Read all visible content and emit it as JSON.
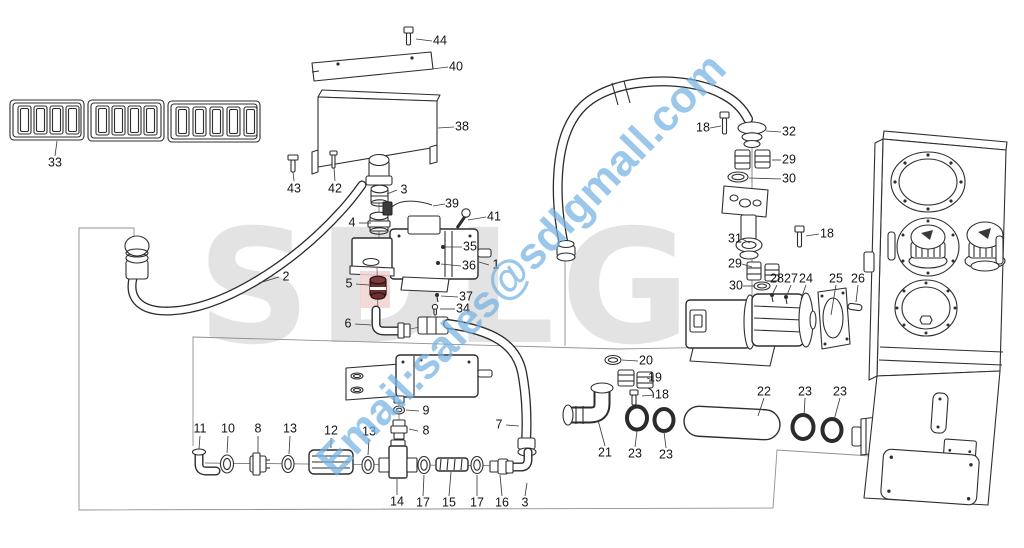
{
  "watermarks": {
    "brand": "SDLG",
    "brand_color": "#000000",
    "brand_opacity": 0.105,
    "email": "Email:sales@sdlgmall.com",
    "email_color": "#74b2e2",
    "email_opacity": 0.72
  },
  "highlight": {
    "part": "5",
    "color": "#f2d2d2"
  },
  "callouts": [
    {
      "n": "44",
      "x": 440,
      "y": 41,
      "leader": [
        432,
        41,
        416,
        39
      ]
    },
    {
      "n": "40",
      "x": 456,
      "y": 67,
      "leader": [
        448,
        67,
        432,
        69
      ]
    },
    {
      "n": "38",
      "x": 462,
      "y": 127,
      "leader": [
        454,
        127,
        438,
        128
      ]
    },
    {
      "n": "33",
      "x": 55,
      "y": 163,
      "leader": [
        55,
        156,
        57,
        141
      ]
    },
    {
      "n": "43",
      "x": 294,
      "y": 189,
      "leader": [
        294,
        181,
        293,
        172
      ]
    },
    {
      "n": "42",
      "x": 335,
      "y": 189,
      "leader": [
        335,
        181,
        334,
        168
      ]
    },
    {
      "n": "3",
      "x": 404,
      "y": 190,
      "leader": [
        397,
        190,
        387,
        194
      ]
    },
    {
      "n": "39",
      "x": 452,
      "y": 204,
      "leader": [
        445,
        204,
        433,
        206
      ]
    },
    {
      "n": "41",
      "x": 494,
      "y": 217,
      "leader": [
        486,
        217,
        468,
        220
      ]
    },
    {
      "n": "4",
      "x": 352,
      "y": 223,
      "leader": [
        359,
        223,
        371,
        223
      ]
    },
    {
      "n": "35",
      "x": 470,
      "y": 247,
      "leader": [
        462,
        247,
        445,
        247
      ]
    },
    {
      "n": "36",
      "x": 469,
      "y": 266,
      "leader": [
        461,
        266,
        441,
        264
      ]
    },
    {
      "n": "1",
      "x": 496,
      "y": 265,
      "leader": [
        489,
        265,
        479,
        262
      ]
    },
    {
      "n": "2",
      "x": 286,
      "y": 277,
      "leader": [
        279,
        277,
        259,
        283
      ]
    },
    {
      "n": "5",
      "x": 349,
      "y": 284,
      "leader": [
        356,
        284,
        369,
        285
      ]
    },
    {
      "n": "37",
      "x": 466,
      "y": 297,
      "leader": [
        458,
        297,
        441,
        296
      ]
    },
    {
      "n": "34",
      "x": 463,
      "y": 309,
      "leader": [
        455,
        309,
        440,
        309
      ]
    },
    {
      "n": "6",
      "x": 348,
      "y": 324,
      "leader": [
        355,
        324,
        371,
        325
      ]
    },
    {
      "n": "18",
      "x": 703,
      "y": 128,
      "leader": [
        710,
        128,
        721,
        126
      ]
    },
    {
      "n": "32",
      "x": 789,
      "y": 132,
      "leader": [
        781,
        132,
        766,
        131
      ]
    },
    {
      "n": "29",
      "x": 789,
      "y": 160,
      "leader": [
        781,
        160,
        772,
        160
      ]
    },
    {
      "n": "30",
      "x": 789,
      "y": 179,
      "leader": [
        781,
        179,
        749,
        178
      ]
    },
    {
      "n": "31",
      "x": 735,
      "y": 239,
      "leader": [
        742,
        239,
        750,
        243
      ]
    },
    {
      "n": "18",
      "x": 827,
      "y": 234,
      "leader": [
        819,
        234,
        806,
        236
      ]
    },
    {
      "n": "29",
      "x": 735,
      "y": 264,
      "leader": [
        742,
        264,
        752,
        267
      ]
    },
    {
      "n": "30",
      "x": 736,
      "y": 286,
      "leader": [
        743,
        286,
        755,
        286
      ]
    },
    {
      "n": "28",
      "x": 777,
      "y": 279,
      "leader": [
        777,
        285,
        773,
        293
      ]
    },
    {
      "n": "27",
      "x": 791,
      "y": 279,
      "leader": [
        791,
        285,
        787,
        295
      ]
    },
    {
      "n": "24",
      "x": 806,
      "y": 279,
      "leader": [
        806,
        285,
        801,
        299
      ]
    },
    {
      "n": "25",
      "x": 836,
      "y": 279,
      "leader": [
        836,
        285,
        831,
        315
      ]
    },
    {
      "n": "26",
      "x": 858,
      "y": 279,
      "leader": [
        858,
        285,
        856,
        302
      ]
    },
    {
      "n": "20",
      "x": 646,
      "y": 361,
      "leader": [
        638,
        361,
        622,
        360
      ]
    },
    {
      "n": "19",
      "x": 655,
      "y": 378,
      "leader": [
        647,
        378,
        653,
        380
      ]
    },
    {
      "n": "18",
      "x": 662,
      "y": 395,
      "leader": [
        654,
        395,
        642,
        396
      ]
    },
    {
      "n": "22",
      "x": 764,
      "y": 392,
      "leader": [
        764,
        398,
        758,
        416
      ]
    },
    {
      "n": "23",
      "x": 805,
      "y": 392,
      "leader": [
        805,
        398,
        804,
        417
      ]
    },
    {
      "n": "23",
      "x": 840,
      "y": 392,
      "leader": [
        840,
        398,
        834,
        420
      ]
    },
    {
      "n": "9",
      "x": 426,
      "y": 411,
      "leader": [
        419,
        411,
        406,
        410
      ]
    },
    {
      "n": "8",
      "x": 426,
      "y": 431,
      "leader": [
        418,
        431,
        409,
        429
      ]
    },
    {
      "n": "7",
      "x": 499,
      "y": 425,
      "leader": [
        506,
        425,
        519,
        426
      ]
    },
    {
      "n": "11",
      "x": 200,
      "y": 429,
      "leader": [
        200,
        436,
        199,
        449
      ]
    },
    {
      "n": "10",
      "x": 228,
      "y": 429,
      "leader": [
        228,
        436,
        227,
        453
      ]
    },
    {
      "n": "8",
      "x": 258,
      "y": 429,
      "leader": [
        258,
        436,
        258,
        453
      ]
    },
    {
      "n": "13",
      "x": 290,
      "y": 429,
      "leader": [
        290,
        436,
        289,
        454
      ]
    },
    {
      "n": "12",
      "x": 331,
      "y": 431,
      "leader": [
        331,
        438,
        331,
        448
      ]
    },
    {
      "n": "13",
      "x": 369,
      "y": 432,
      "leader": [
        369,
        439,
        368,
        455
      ]
    },
    {
      "n": "21",
      "x": 605,
      "y": 453,
      "leader": [
        605,
        446,
        598,
        420
      ]
    },
    {
      "n": "23",
      "x": 635,
      "y": 454,
      "leader": [
        635,
        447,
        637,
        431
      ]
    },
    {
      "n": "23",
      "x": 666,
      "y": 455,
      "leader": [
        666,
        448,
        664,
        432
      ]
    },
    {
      "n": "14",
      "x": 397,
      "y": 502,
      "leader": [
        397,
        495,
        397,
        479
      ]
    },
    {
      "n": "17",
      "x": 423,
      "y": 503,
      "leader": [
        423,
        496,
        424,
        475
      ]
    },
    {
      "n": "15",
      "x": 449,
      "y": 503,
      "leader": [
        449,
        496,
        451,
        472
      ]
    },
    {
      "n": "17",
      "x": 477,
      "y": 503,
      "leader": [
        477,
        496,
        477,
        475
      ]
    },
    {
      "n": "16",
      "x": 502,
      "y": 503,
      "leader": [
        502,
        496,
        500,
        475
      ]
    },
    {
      "n": "3",
      "x": 525,
      "y": 503,
      "leader": [
        525,
        496,
        527,
        483
      ]
    }
  ]
}
